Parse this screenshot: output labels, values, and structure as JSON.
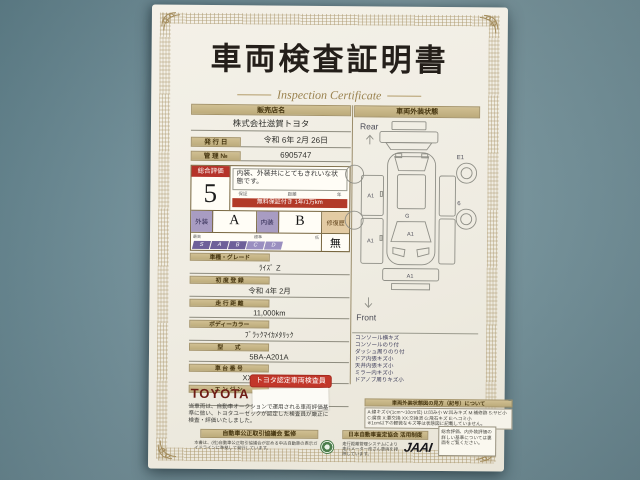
{
  "title": "車両検査証明書",
  "subtitle": "Inspection Certificate",
  "dealer": {
    "label": "販売店名",
    "value": "株式会社滋賀トヨタ"
  },
  "issue": {
    "label": "発 行 日",
    "value": "令和 6年 2月 26日"
  },
  "control": {
    "label": "管 理 №",
    "value": "6905747"
  },
  "evaluation": {
    "label": "総合評価",
    "score": "5",
    "comment": "内装、外装共にとてもきれいな状態です。",
    "warranty_caps": {
      "left": "保証",
      "mid": "距離",
      "right": "年"
    },
    "warranty_band": "無料保証付き 1年/1万km",
    "exterior_label": "外装",
    "exterior_grade": "A",
    "interior_label": "内装",
    "interior_grade": "B",
    "repair_label": "修復歴",
    "repair_value": "無",
    "scale_caps": {
      "left": "最高",
      "mid": "標準",
      "right": "低"
    },
    "scale_letters": [
      "S",
      "A",
      "B",
      "C",
      "D"
    ]
  },
  "fields": [
    {
      "label": "車種・グレード",
      "value": "ﾗｲｽﾞ Z"
    },
    {
      "label": "初 度 登 録",
      "value": "令和 4年 2月"
    },
    {
      "label": "走 行 距 離",
      "value": "11,000km"
    },
    {
      "label": "ボディーカラー",
      "value": "ﾌﾞﾗｯｸﾏｲｶﾒﾀﾘｯｸ"
    },
    {
      "label": "型　　式",
      "value": "5BA-A201A"
    },
    {
      "label": "車 台 番 号",
      "value": "XXXXXXXX994"
    },
    {
      "label": "エ ン ジ ン",
      "value": "ガソリン"
    }
  ],
  "inspector": {
    "brand": "TOYOTA",
    "stamp": "トヨタ認定車両検査員"
  },
  "exterior_panel": {
    "header": "車両外装状態",
    "rear_label": "Rear",
    "front_label": "Front",
    "marks": {
      "wheel_tr": "E1",
      "wheel_r": "6",
      "side_left_upper": "A1",
      "side_left_lower": "A1",
      "roof": "G",
      "windshield": "A1",
      "front_bumper": "A1"
    },
    "legend": [
      "コンソール横キズ",
      "コンソールのり付",
      "ダッシュ周りのり付",
      "ドア内張キズ小",
      "天井内張キズ小",
      "ミラー内キズ小",
      "ドアノブ周りキズ小"
    ]
  },
  "notes": {
    "left": "当車両は、自動車オークションで運用される車両評価基準に倣い、トヨタユーゼックが認定した検査員が厳正に検査・評価いたしました。",
    "guide_header": "車両外装状態図の見方（記号）について",
    "guide_lines": [
      "A:線キズ小(1cm〜10cm位) U:凹み小 W:凹みキズ M:補修跡 S:サビ小",
      "C:腐食 X:要交換 XX:交換済 G:飛石キズ E:ヘコミ小",
      "※1cm以下の軽微なキズ等は状態図に記載していません。"
    ]
  },
  "footer": {
    "left_band": "自動車公正取引協議会 監修",
    "left_lines": "本書は、(社)自動車公正取引協議会が定める中古自動車の表示ガイドラインに準拠して発行しています。",
    "mid_band": "日本自動車査定協会 活用制度",
    "mid_lines": "走行距離管理システムにより走行メーター改ざん車両を排除しています。",
    "jaai": "JAAI",
    "right_box": "総合評価、内外装評価の詳しい基準については裏面をご覧ください。"
  }
}
